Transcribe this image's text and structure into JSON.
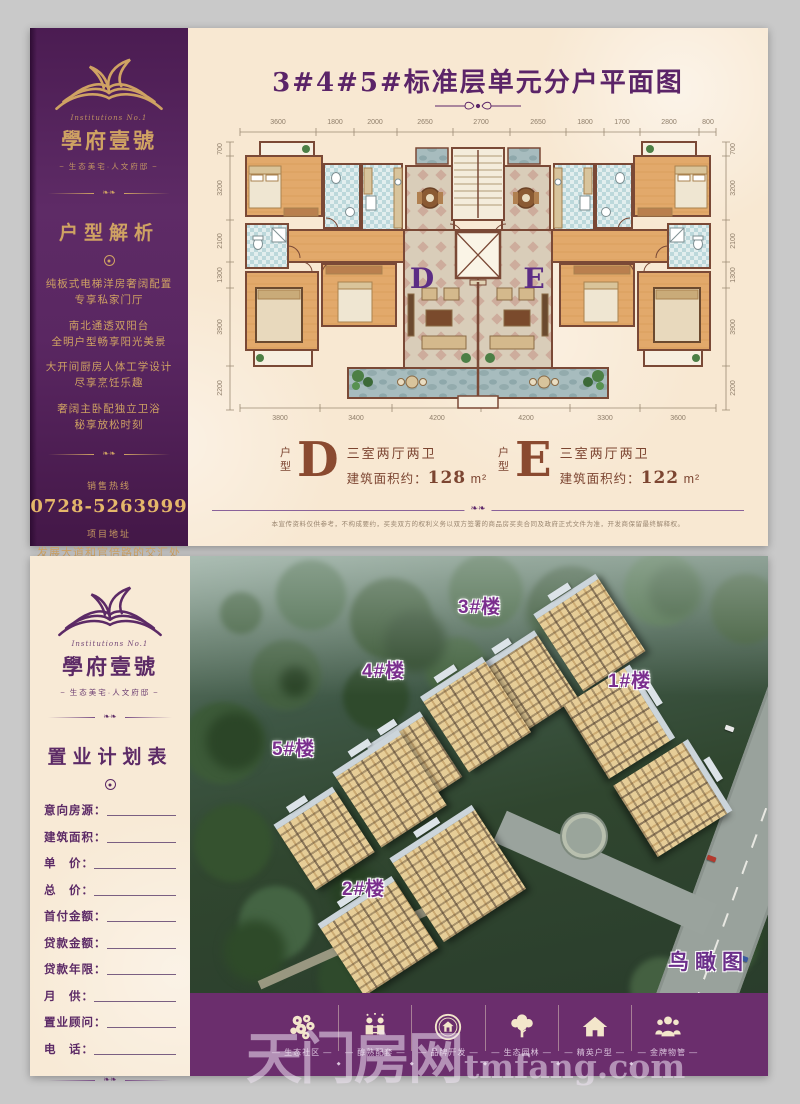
{
  "brand": {
    "script": "Institutions No.1",
    "name": "學府壹號",
    "tagline": "生态美宅·人文府邸"
  },
  "top_panel": {
    "title": "3#4#5#标准层单元分户平面图",
    "sidebar": {
      "section_title": "户型解析",
      "bullets": [
        "纯板式电梯洋房奢阔配置",
        "专享私家门厅",
        "南北通透双阳台",
        "全明户型畅享阳光美景",
        "大开间厨房人体工学设计",
        "尽享烹饪乐趣",
        "奢阔主卧配独立卫浴",
        "秘享放松时刻"
      ],
      "hotline_label": "销售热线",
      "hotline": "0728-5263999",
      "address_label": "项目地址",
      "address": "发展大道和官倍路的交汇处"
    },
    "plan": {
      "letter_d": "D",
      "letter_e": "E",
      "dims_top": [
        "3600",
        "1800",
        "2000",
        "2650",
        "2700",
        "2650",
        "1800",
        "1700",
        "2800",
        "800"
      ],
      "dims_bottom": [
        "3800",
        "3400",
        "4200",
        "4200",
        "3300",
        "3600"
      ],
      "dims_left": [
        "700",
        "3200",
        "2100",
        "1300",
        "3900",
        "2200"
      ],
      "dims_right": [
        "700",
        "3200",
        "2100",
        "1300",
        "3900",
        "2200"
      ]
    },
    "units": [
      {
        "label_zh": "户型",
        "letter": "D",
        "rooms": "三室两厅两卫",
        "area_label": "建筑面积约：",
        "area_value": "128",
        "area_unit": "m²"
      },
      {
        "label_zh": "户型",
        "letter": "E",
        "rooms": "三室两厅两卫",
        "area_label": "建筑面积约：",
        "area_value": "122",
        "area_unit": "m²"
      }
    ],
    "disclaimer": "本宣传资料仅供参考，不构成要约，买卖双方的权利义务以双方签署的商品房买卖合同及政府正式文件为准，开发商保留最终解释权。"
  },
  "bottom_panel": {
    "sidebar": {
      "section_title": "置业计划表",
      "form_rows": [
        "意向房源：",
        "建筑面积：",
        "单　价：",
        "总　价：",
        "首付金额：",
        "贷款金额：",
        "贷款年限：",
        "月　供：",
        "置业顾问：",
        "电　话："
      ]
    },
    "photo": {
      "building_labels": [
        "3#楼",
        "4#楼",
        "1#楼",
        "5#楼",
        "2#楼"
      ],
      "caption": "鸟瞰图"
    },
    "footer_items": [
      {
        "label": "— 生态社区 —"
      },
      {
        "label": "— 醇熟配套 —"
      },
      {
        "label": "— 品牌开发 —"
      },
      {
        "label": "— 生态园林 —"
      },
      {
        "label": "— 精英户型 —"
      },
      {
        "label": "— 金牌物管 —"
      }
    ]
  },
  "watermark": {
    "cjk": "天门房网",
    "domain": "tmfang.com"
  },
  "colors": {
    "sidebar_purple": "#552158",
    "gold": "#cfa263",
    "title_purple": "#5b2468",
    "bar_purple": "#6b2e6d",
    "label_purple": "#7b2f8e"
  }
}
